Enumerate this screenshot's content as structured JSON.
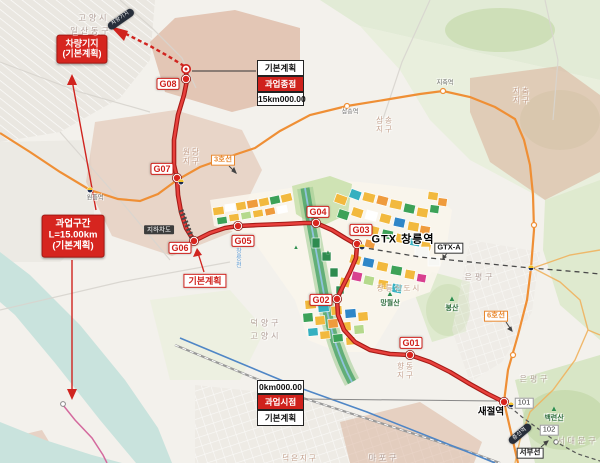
{
  "stations": {
    "g01": "G01",
    "g02": "G02",
    "g03": "G03",
    "g04": "G04",
    "g05": "G05",
    "g06": "G06",
    "g07": "G07",
    "g08": "G08"
  },
  "callouts": {
    "depot_line1": "차량기지",
    "depot_line2": "(기본계획)",
    "section_line1": "과업구간",
    "section_line2": "L=15.00km",
    "section_line3": "(기본계획)",
    "plan_mid": "기본계획",
    "end_plan": "기본계획",
    "end_name": "과업종점",
    "end_km": "15km000.00",
    "start_km": "0km000.00",
    "start_name": "과업시점",
    "start_plan": "기본계획",
    "underpass": "지하차도"
  },
  "lines": {
    "line3": "3호선",
    "line6": "6호선",
    "gtxa": "GTX-A",
    "seobu": "서부선",
    "s101": "101",
    "s102": "102"
  },
  "places": {
    "saejeol": "새절역",
    "changneung": "GTX 창릉역",
    "samsong_st": "삼송역",
    "jichuk_st": "지축역",
    "wonheung_st": "원흥역",
    "capsule_top": "차량기지",
    "capsule_bottom": "증산역",
    "mt_bongsan": "봉산",
    "mt_baekryeon": "백련산",
    "mt_mangwol": "망월산",
    "adm_goyang1": "고양시",
    "adm_ilsan": "일산동구",
    "adm_deogyang": "덕양구",
    "adm_goyang2": "고양시",
    "adm_eunpyeong1": "은평구",
    "adm_eunpyeong2": "은평구",
    "adm_seodaemun": "서대문구",
    "adm_mapo": "마포구",
    "zone_jichuk_1": "지축",
    "zone_jichuk_2": "지구",
    "zone_wondang_1": "원당",
    "zone_wondang_2": "지구",
    "zone_samsong_1": "삼송",
    "zone_samsong_2": "지구",
    "zone_hyangdong_1": "향동",
    "zone_hyangdong_2": "지구",
    "zone_newtown": "창릉신도시",
    "zone_deokeun": "덕은지구",
    "stream": "창릉천"
  },
  "icons": {
    "mountain": "▲"
  },
  "colors": {
    "route": "#cf211c",
    "line3": "#ef8f35",
    "river": "#c9e3dd",
    "gtx_dash": "#4a4a4a"
  }
}
